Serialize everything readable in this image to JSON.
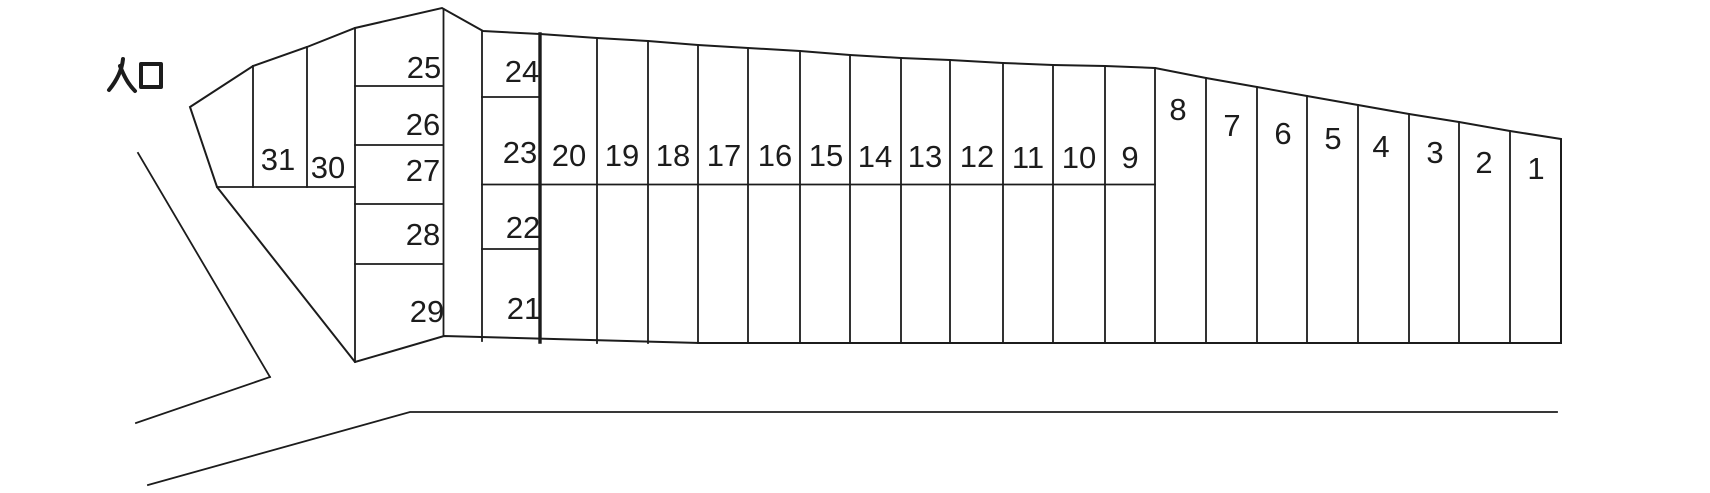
{
  "diagram": {
    "type": "parking-lot-layout",
    "entrance_label": "入口",
    "colors": {
      "line": "#1c1c1c",
      "background": "#ffffff"
    },
    "stalls": [
      {
        "label": "1"
      },
      {
        "label": "2"
      },
      {
        "label": "3"
      },
      {
        "label": "4"
      },
      {
        "label": "5"
      },
      {
        "label": "6"
      },
      {
        "label": "7"
      },
      {
        "label": "8"
      },
      {
        "label": "9"
      },
      {
        "label": "10"
      },
      {
        "label": "11"
      },
      {
        "label": "12"
      },
      {
        "label": "13"
      },
      {
        "label": "14"
      },
      {
        "label": "15"
      },
      {
        "label": "16"
      },
      {
        "label": "17"
      },
      {
        "label": "18"
      },
      {
        "label": "19"
      },
      {
        "label": "20"
      },
      {
        "label": "21"
      },
      {
        "label": "22"
      },
      {
        "label": "23"
      },
      {
        "label": "24"
      },
      {
        "label": "25"
      },
      {
        "label": "26"
      },
      {
        "label": "27"
      },
      {
        "label": "28"
      },
      {
        "label": "29"
      },
      {
        "label": "30"
      },
      {
        "label": "31"
      }
    ]
  }
}
